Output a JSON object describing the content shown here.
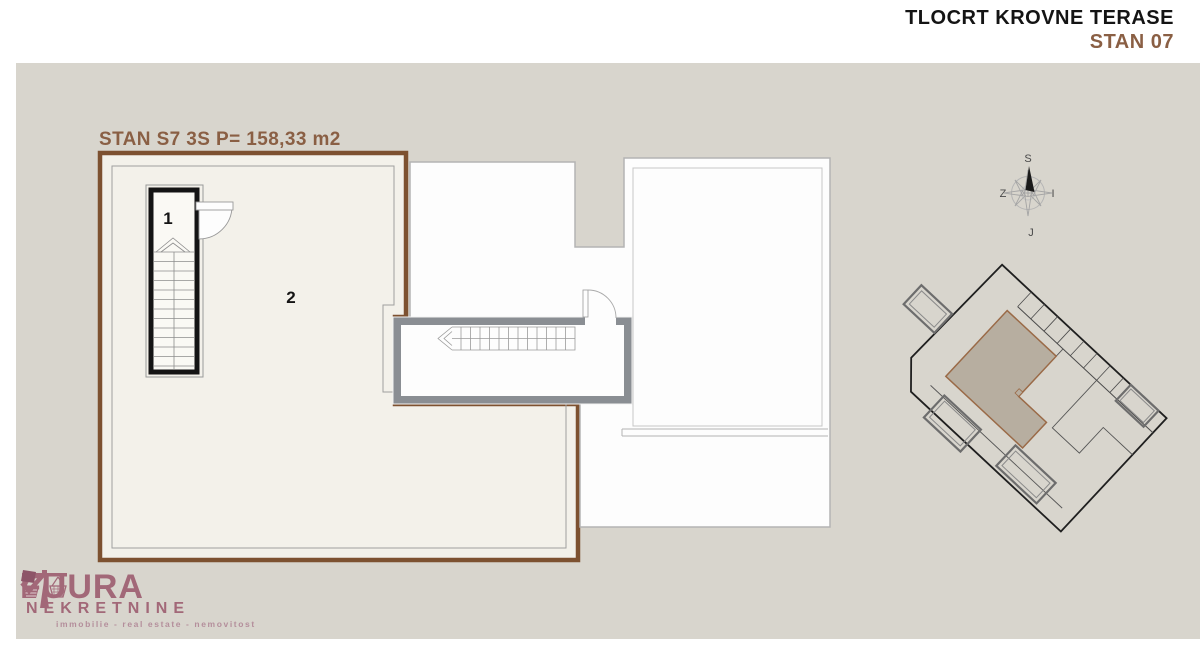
{
  "header": {
    "title": "TLOCRT KROVNE TERASE",
    "subtitle": "STAN 07"
  },
  "plan": {
    "label": "STAN S7 3S P= 158,33 m2",
    "stair_room_number": "1",
    "terrace_room_number": "2"
  },
  "compass": {
    "north": "S",
    "south": "J",
    "west": "Z",
    "east": "I"
  },
  "logo": {
    "name_part1": "FU",
    "name_part2": "URA",
    "subtitle": "NEKRETNINE",
    "tagline": "immobilie - real estate - nemovitost"
  },
  "colors": {
    "canvas_beige": "#d8d5cd",
    "terrace_cream": "#f3f1ea",
    "outline_brown": "#7d5130",
    "accent_brown_text": "#8a5f44",
    "wall_gray": "#8a8e93",
    "stair_black": "#141414",
    "neighbor_white": "#fdfdfd",
    "logo_mauve": "#a26878",
    "siteplan_unit_fill": "#b7aea0"
  }
}
